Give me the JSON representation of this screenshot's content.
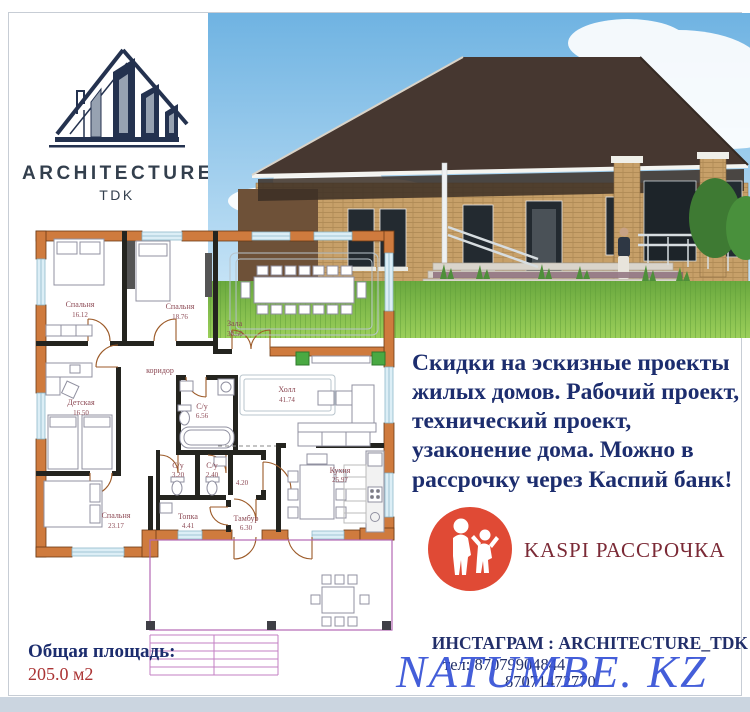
{
  "logo": {
    "brand": "ARCHITECTURE",
    "sub": "TDK"
  },
  "promo": {
    "color": "#1c2d6e",
    "lines": [
      "Скидки на эскизные проекты",
      "жилых домов. Рабочий проект,",
      "технический проект,",
      "узаконение дома. Можно в",
      "рассрочку через Каспий банк!"
    ]
  },
  "kaspi": {
    "label": "KASPI РАССРОЧКА",
    "badge_color": "#e04a35",
    "text_color": "#7b2a36"
  },
  "floor_plan": {
    "rooms": [
      {
        "name": "Спальня",
        "area": "16.12"
      },
      {
        "name": "Спальня",
        "area": "18.76"
      },
      {
        "name": "Зала",
        "area": "38.50"
      },
      {
        "name": "Детская",
        "area": "16.50"
      },
      {
        "name": "коридор",
        "area": ""
      },
      {
        "name": "С/у",
        "area": "6.56"
      },
      {
        "name": "Холл",
        "area": "41.74"
      },
      {
        "name": "С/у",
        "area": "3.20"
      },
      {
        "name": "С/у",
        "area": "2.40"
      },
      {
        "name": "",
        "area": "4.20"
      },
      {
        "name": "Спальня",
        "area": "23.17"
      },
      {
        "name": "Топка",
        "area": "4.41"
      },
      {
        "name": "Тамбур",
        "area": "6.30"
      },
      {
        "name": "Кухня",
        "area": "25.97"
      }
    ],
    "total_label": "Общая площадь:",
    "total_value": "205.0 м2"
  },
  "contacts": {
    "instagram": "ИНСТАГРАМ : ARCHITECTURE_TDK",
    "phone1": "тел: 87079904844",
    "phone2": "87071472770"
  },
  "watermark": {
    "text": "NATUMBE. KZ",
    "color": "#3551d6"
  }
}
